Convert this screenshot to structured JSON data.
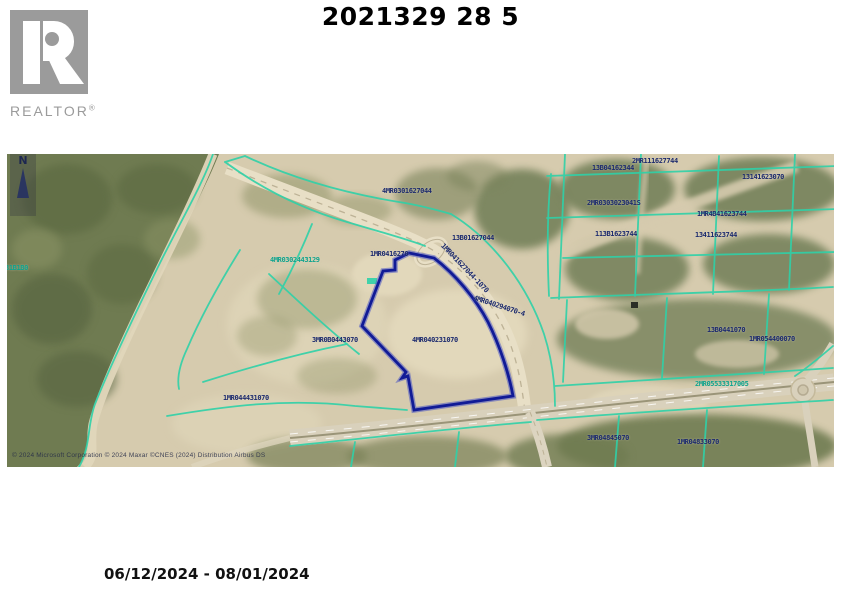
{
  "page": {
    "title": "2021329 28 5",
    "date_range": "06/12/2024 - 08/01/2024"
  },
  "logo": {
    "brand": "REALTOR",
    "registered": "®"
  },
  "map": {
    "north_label": "N",
    "attribution": "© 2024 Microsoft Corporation © 2024 Maxar ©CNES (2024) Distribution Airbus DS",
    "colors": {
      "navy": "#1c2a6e",
      "teal": "#0fa38e",
      "parcel_line": "#2fd1a8",
      "subject_parcel": "#111b96",
      "sand": "#d6cbae",
      "vegetation": "#6f7b51"
    },
    "labels": [
      {
        "text": "4MR0301627044",
        "x": 375,
        "y": 33,
        "color": "navy",
        "rotate": 0
      },
      {
        "text": "13B01627044",
        "x": 445,
        "y": 80,
        "color": "navy",
        "rotate": 0
      },
      {
        "text": "1MR0416270",
        "x": 363,
        "y": 96,
        "color": "navy",
        "rotate": 0
      },
      {
        "text": "4MR0302443129",
        "x": 263,
        "y": 102,
        "color": "teal",
        "rotate": 0
      },
      {
        "text": "2MR111627744",
        "x": 625,
        "y": 3,
        "color": "navy",
        "rotate": 0
      },
      {
        "text": "13B04162344",
        "x": 585,
        "y": 10,
        "color": "navy",
        "rotate": 0
      },
      {
        "text": "2MR0303023041S",
        "x": 580,
        "y": 45,
        "color": "navy",
        "rotate": 0
      },
      {
        "text": "113B1623744",
        "x": 588,
        "y": 76,
        "color": "navy",
        "rotate": 0
      },
      {
        "text": "1MR4B41623744",
        "x": 690,
        "y": 56,
        "color": "navy",
        "rotate": 0
      },
      {
        "text": "13411623744",
        "x": 688,
        "y": 77,
        "color": "navy",
        "rotate": 0
      },
      {
        "text": "13141623070",
        "x": 735,
        "y": 19,
        "color": "navy",
        "rotate": 0
      },
      {
        "text": "13B0441070",
        "x": 700,
        "y": 172,
        "color": "navy",
        "rotate": 0
      },
      {
        "text": "1MR054400070",
        "x": 742,
        "y": 181,
        "color": "navy",
        "rotate": 0
      },
      {
        "text": "2MR05533317005",
        "x": 688,
        "y": 226,
        "color": "teal",
        "rotate": 0
      },
      {
        "text": "3MR0B0443070",
        "x": 305,
        "y": 182,
        "color": "navy",
        "rotate": 0
      },
      {
        "text": "4MR040231070",
        "x": 405,
        "y": 182,
        "color": "navy",
        "rotate": 0
      },
      {
        "text": "4MR040294070-4",
        "x": 468,
        "y": 140,
        "color": "navy",
        "rotate": 18
      },
      {
        "text": "1MR044431070",
        "x": 216,
        "y": 240,
        "color": "navy",
        "rotate": 0
      },
      {
        "text": "3MR04845070",
        "x": 580,
        "y": 280,
        "color": "navy",
        "rotate": 0
      },
      {
        "text": "1MR04833070",
        "x": 670,
        "y": 284,
        "color": "navy",
        "rotate": 0
      },
      {
        "text": "31B1B0",
        "x": -2,
        "y": 110,
        "color": "teal",
        "rotate": 0
      },
      {
        "text": "1MR041627044-1070",
        "x": 438,
        "y": 88,
        "color": "navy",
        "rotate": 46
      }
    ]
  }
}
